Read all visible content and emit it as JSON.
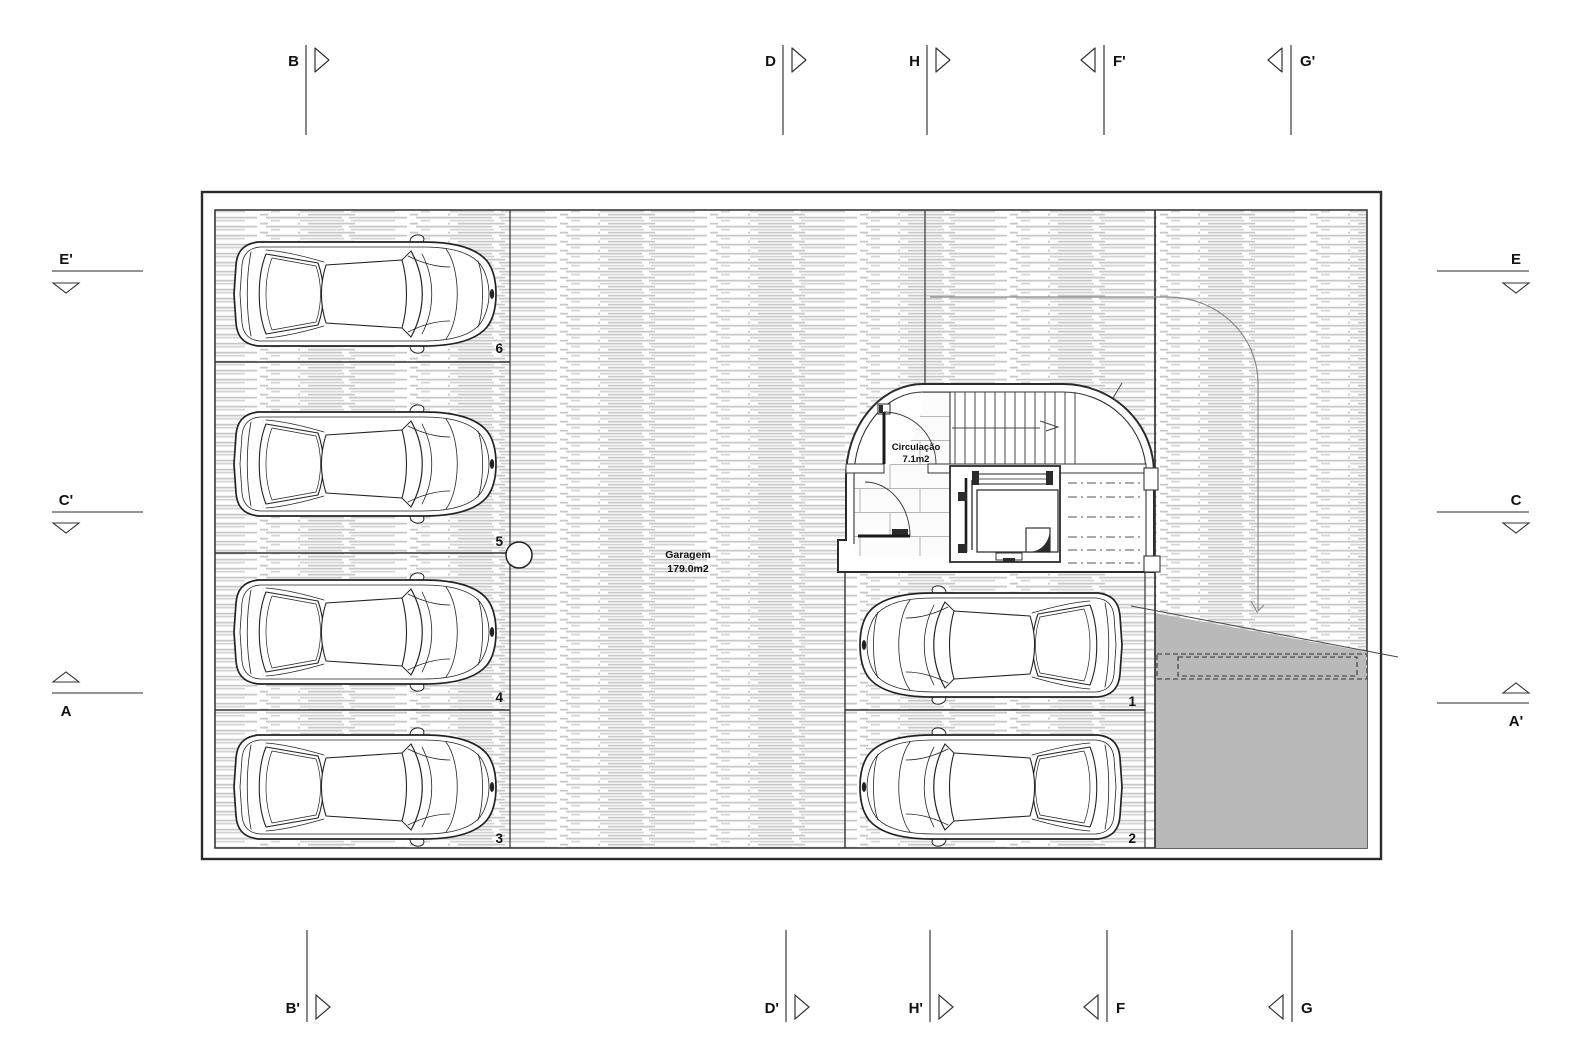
{
  "drawing": {
    "garage_label": "Garagem",
    "garage_area": "179.0m2",
    "circulation_label": "Circulação",
    "circulation_area": "7.1m2",
    "stalls": [
      "1",
      "2",
      "3",
      "4",
      "5",
      "6"
    ]
  },
  "markers": {
    "top": [
      {
        "label": "B"
      },
      {
        "label": "D"
      },
      {
        "label": "H"
      },
      {
        "label": "F'"
      },
      {
        "label": "G'"
      }
    ],
    "bottom": [
      {
        "label": "B'"
      },
      {
        "label": "D'"
      },
      {
        "label": "H'"
      },
      {
        "label": "F"
      },
      {
        "label": "G"
      }
    ],
    "left": [
      {
        "label": "E'"
      },
      {
        "label": "C'"
      },
      {
        "label": "A"
      }
    ],
    "right": [
      {
        "label": "E"
      },
      {
        "label": "C"
      },
      {
        "label": "A'"
      }
    ]
  },
  "colors": {
    "line": "#2b2b2b",
    "hatch_line": "#c7c7c7",
    "ramp_fill": "#b9b9b9",
    "paper": "#ffffff"
  }
}
